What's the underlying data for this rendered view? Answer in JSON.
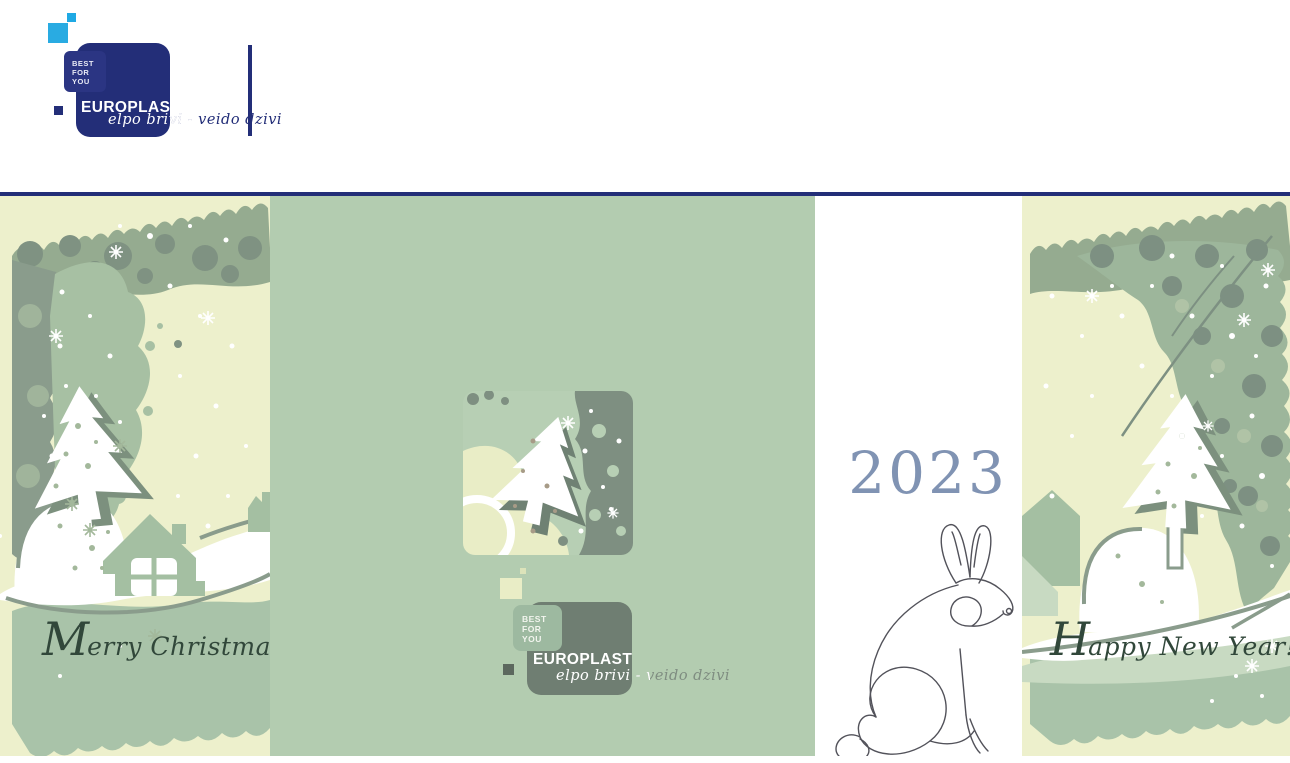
{
  "brand": {
    "name": "EUROPLAST",
    "badge_lines": [
      "BEST",
      "FOR",
      "YOU"
    ],
    "tagline": "elpo brivi - veido dzivi"
  },
  "card": {
    "front_panel": {
      "greeting_initial": "M",
      "greeting_rest": "erry Christmas!"
    },
    "center_panel": {
      "logo_name": "EUROPLAST",
      "badge_lines": [
        "BEST",
        "FOR",
        "YOU"
      ],
      "tagline": "elpo brivi - veido dzivi"
    },
    "year_panel": {
      "year": "2023",
      "illustration": "rabbit-line-art"
    },
    "back_panel": {
      "greeting_initial": "H",
      "greeting_rest": "appy New Year!"
    }
  },
  "colors": {
    "navy": "#232e78",
    "cyan": "#29abe2",
    "center_sage": "#b3ccb0",
    "pale_yellow": "#edf0cc",
    "texture_sage": "#a7c0a3",
    "texture_gray": "#8a9c8c",
    "logo_gray": "#6f7e72",
    "logo_badge_sage": "#9db9a0",
    "year_blue": "#8093b3",
    "greeting_green": "#31473a"
  }
}
